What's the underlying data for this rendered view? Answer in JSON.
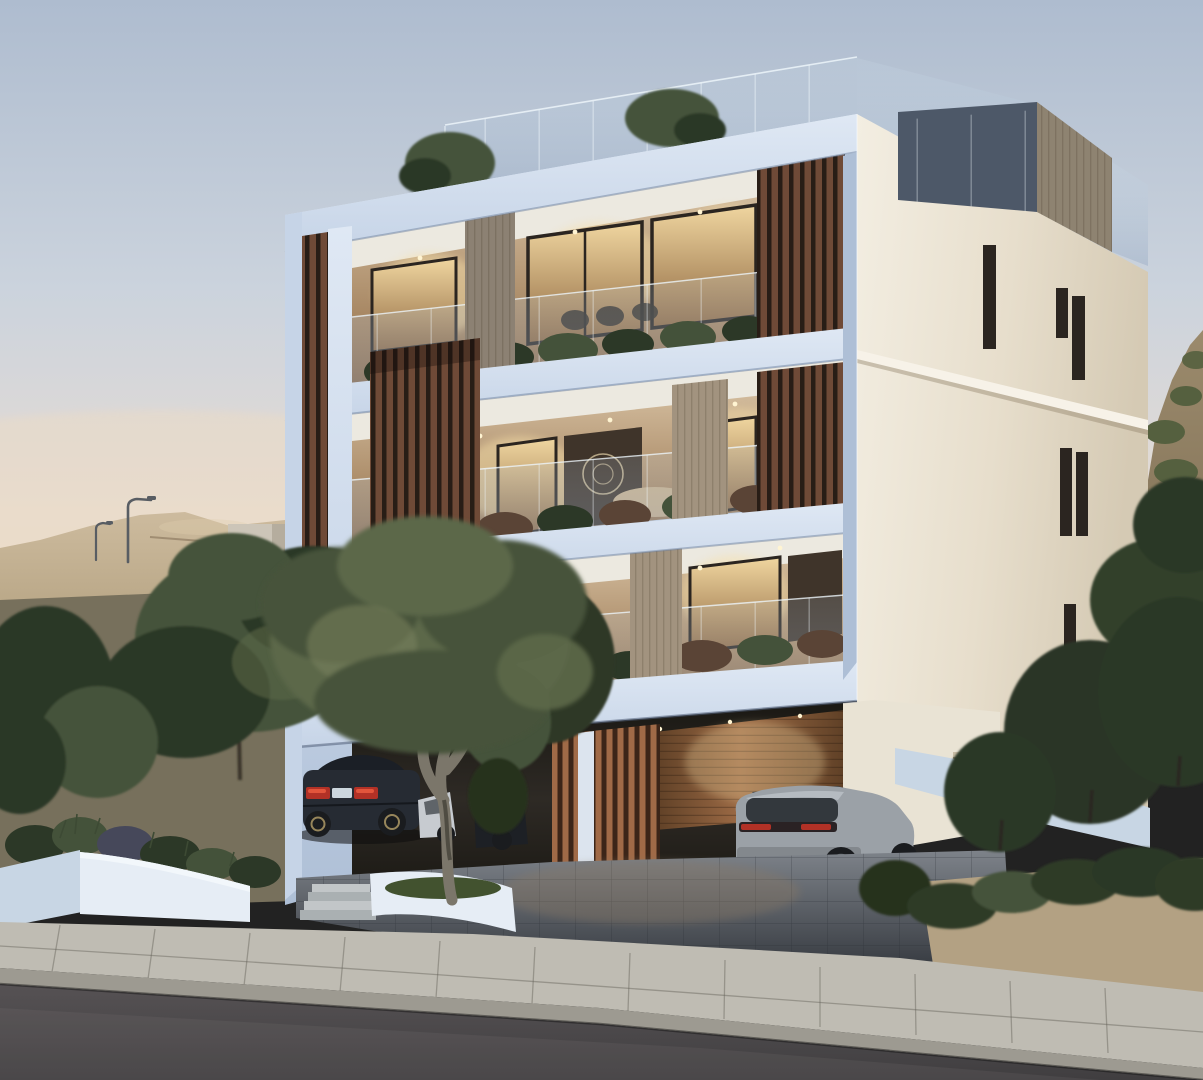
{
  "scene": {
    "description": "Photorealistic dusk rendering of a modern three-storey white apartment building with timber slat screens, glass balcony balustrades, warm-lit interiors, rooftop terrace, ground-level carport with a dark sedan and a grey SUV, white curved planters with an olive tree, sandy hills behind and a sloping asphalt road in the foreground",
    "time_of_day": "dusk",
    "labels": {
      "sky": "dusk sky gradient",
      "hills_left": "sandy excavated hills with street lamps",
      "hill_right": "scrub-covered hillside",
      "building": "three-storey modern apartment building",
      "front_facade": "front facade with stacked balconies",
      "side_facade": "cream side facade with slit windows",
      "rooftop": "rooftop terrace with glass balustrade and stair block",
      "top_balcony": "top floor balcony",
      "middle_balcony": "middle floor balcony",
      "first_balcony": "first floor balcony",
      "slat_screens": "vertical timber slat screens",
      "carport": "ground floor carport",
      "sedan": "dark sedan parked under building",
      "white_car": "white car parked beside sedan",
      "suv": "grey SUV parked in carport",
      "olive_tree": "olive tree in white planter",
      "planters": "white curved planter walls with entrance steps",
      "driveway": "paved driveway",
      "sidewalk": "concrete slab sidewalk with curb",
      "road": "sloping asphalt road",
      "trees_left": "dark green trees on left slope",
      "trees_right": "dark green trees and bushes on right"
    }
  },
  "palette": {
    "sky_top": "#aebccf",
    "sky_mid": "#cbd3dd",
    "sky_low": "#e6dcd4",
    "sky_horizon": "#eddcc8",
    "hill_sand_light": "#cdbb9e",
    "hill_sand_dark": "#a79572",
    "hill_slope": "#77705c",
    "hill_right_light": "#9b8a6c",
    "hill_right_dark": "#7e6e54",
    "scrub_green": "#55603f",
    "concrete_wall": "#ccc5b8",
    "lamp_metal": "#585d63",
    "facade_light": "#dfe8f4",
    "facade_mid": "#c6d4e7",
    "facade_dark": "#aebfd6",
    "facade_deep": "#93a7c2",
    "side_light": "#f3eee2",
    "side_mid": "#e7decc",
    "side_dark": "#d5cab4",
    "trim_white": "#f7f2e8",
    "roof_block_dark": "#4d5868",
    "roof_block_wood": "#8e8371",
    "glass_tint": "#ccdde9",
    "glass_edge": "#edf5fa",
    "slat_bar": "#6f4a37",
    "slat_gap": "#281d16",
    "slat_bar_lit": "#a06a47",
    "slat_gap_lit": "#3c2518",
    "pillar_gray": "#8c8173",
    "pillar_light": "#a2937f",
    "ceiling_white": "#ece9e0",
    "int_wall_warm": "#e2cfb2",
    "int_glow": "#f6dfa8",
    "light_dot": "#fff4d2",
    "win_warm_hi": "#f0d6a0",
    "win_warm_lo": "#8d6740",
    "win_dark": "#3f342a",
    "win_frame": "#2b2520",
    "plant_dark": "#2c3827",
    "plant_mid": "#44523a",
    "plant_light": "#5c6a49",
    "plant_red": "#5a4436",
    "olive_light": "#76815c",
    "olive_mid": "#5c6849",
    "olive_dark": "#46523a",
    "trunk_olive": "#7b766a",
    "trunk_dark": "#3b352c",
    "carport_deep": "#1a1813",
    "carport_mid": "#2e2a25",
    "wood_wall_hi": "#9c6a45",
    "wood_wall_lo": "#5f4026",
    "column_white": "#dce4ee",
    "cream_wall": "#e9e3d4",
    "vent_grille": "#c9bda6",
    "car_dark_body": "#262b33",
    "car_dark_roof": "#1b1f26",
    "tail_red": "#b23126",
    "tail_red_hi": "#e2553c",
    "plate_lit": "#ccd6de",
    "car_white": "#c7cbd0",
    "car_hidden": "#1d2025",
    "alloy": "#97865b",
    "suv_body": "#9ba1a7",
    "suv_roof": "#3e4246",
    "suv_window": "#33383d",
    "suv_bumper": "#83888d",
    "suv_dark": "#3c4042",
    "wheel_dark": "#1a1c1f",
    "rim_gray": "#5f6569",
    "drive_paver": "#7e838a",
    "drive_line": "#34383e",
    "drive_warm": "#8d7a64",
    "planter_light": "#e6edf5",
    "planter_mid": "#c8d6e4",
    "planter_shadow": "#a7bacf",
    "grass_green": "#42522f",
    "step_light": "#c2c6c8",
    "step_dark": "#aab0b2",
    "walk_light": "#bfbcb3",
    "walk_dark": "#9d9a91",
    "walk_joint": "#6f6c62",
    "road_dark": "#403e40",
    "road_light": "#565254",
    "shadow_black": "#0c0c0c"
  }
}
